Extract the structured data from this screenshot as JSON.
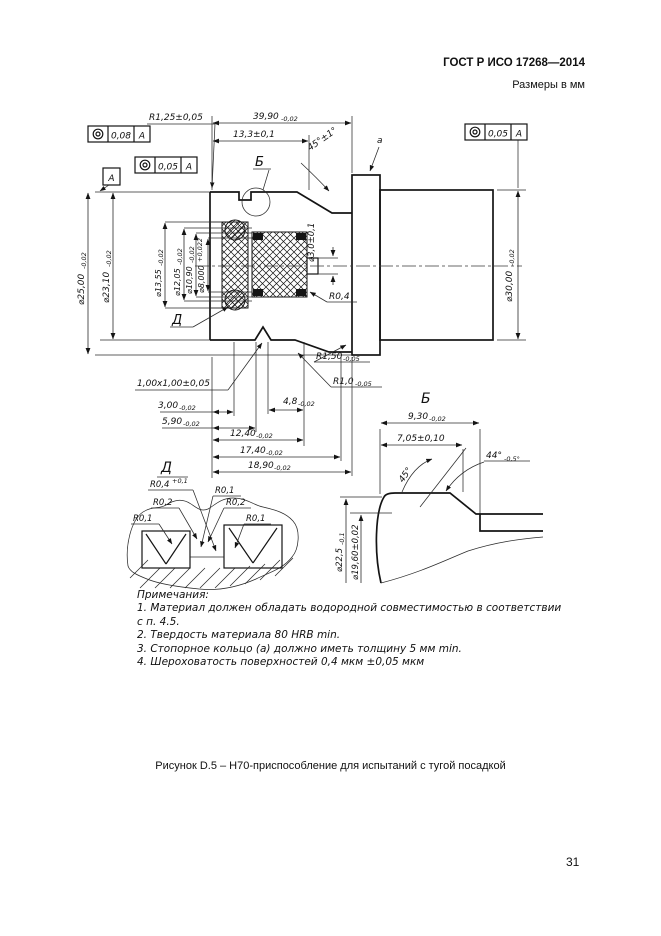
{
  "header": {
    "standard": "ГОСТ Р ИСО 17268—2014",
    "units": "Размеры в мм"
  },
  "footer": {
    "caption": "Рисунок D.5 – Н70-приспособление для испытаний с тугой посадкой",
    "page_number": "31"
  },
  "gdt": {
    "frame_left_top": {
      "symbol": "concentricity",
      "tolerance": "0,08",
      "datum": "A"
    },
    "frame_left_mid": {
      "symbol": "concentricity",
      "tolerance": "0,05",
      "datum": "A"
    },
    "frame_right_top": {
      "symbol": "concentricity",
      "tolerance": "0,05",
      "datum": "A"
    },
    "datum_flag": "A",
    "ring_ref_label": "a"
  },
  "main_view": {
    "callout_b": "Б",
    "callout_d": "Д",
    "dims": {
      "edge_radius": "R1,25±0,05",
      "len_total": {
        "v": "39,90",
        "t": "-0,02"
      },
      "len_13_3": "13,3±0,1",
      "chamfer_angle": "45°±1°",
      "d25": {
        "v": "⌀25,00",
        "t": "-0,02"
      },
      "d23_10": {
        "v": "⌀23,10",
        "t": "-0,02"
      },
      "d13_55": {
        "v": "⌀13,55",
        "t": "-0,02"
      },
      "d12_05": {
        "v": "⌀12,05",
        "t": "-0,02"
      },
      "d10_90": {
        "v": "⌀10,90",
        "t": "-0,02"
      },
      "d8_000": {
        "v": "⌀8,000",
        "t": "+0,022"
      },
      "d3_0": "⌀3,0±0,1",
      "d30": {
        "v": "⌀30,00",
        "t": "-0,02"
      },
      "r0_4": "R0,4",
      "r1_50": {
        "v": "R1,50",
        "t": "-0,05"
      },
      "r1_0": {
        "v": "R1,0",
        "t": "-0,05"
      },
      "groove_1x1": "1,00x1,00±0,05",
      "len_3_00": {
        "v": "3,00",
        "t": "-0,02"
      },
      "len_5_90": {
        "v": "5,90",
        "t": "-0,02"
      },
      "len_4_8": {
        "v": "4,8",
        "t": "-0,02"
      },
      "len_12_40": {
        "v": "12,40",
        "t": "-0,02"
      },
      "len_17_40": {
        "v": "17,40",
        "t": "-0,02"
      },
      "len_18_90": {
        "v": "18,90",
        "t": "-0,02"
      }
    }
  },
  "detail_b": {
    "title": "Б",
    "dims": {
      "w9_30": {
        "v": "9,30",
        "t": "-0,02"
      },
      "w7_05": "7,05±0,10",
      "angle45": "45°",
      "angle44": {
        "v": "44°",
        "t": "-0,5°"
      },
      "d22_5": {
        "v": "⌀22,5",
        "t": "-0,1"
      },
      "d19_60": "⌀19,60±0,02"
    }
  },
  "detail_d": {
    "title": "Д",
    "labels": {
      "r0_4": {
        "v": "R0,4",
        "t": "+0,1"
      },
      "r0_2_left": "R0,2",
      "r0_1_left": "R0,1",
      "r0_1_top": "R0,1",
      "r0_2_right": "R0,2",
      "r0_1_right": "R0,1"
    }
  },
  "notes": {
    "heading": "Примечания:",
    "items": [
      "1. Материал должен обладать водородной совместимостью в соответствии с п. 4.5.",
      "2. Твердость материала 80 HRB min.",
      "3. Стопорное кольцо (а) должно иметь толщину 5 мм min.",
      "4. Шероховатость поверхностей 0,4 мкм ±0,05 мкм"
    ]
  }
}
